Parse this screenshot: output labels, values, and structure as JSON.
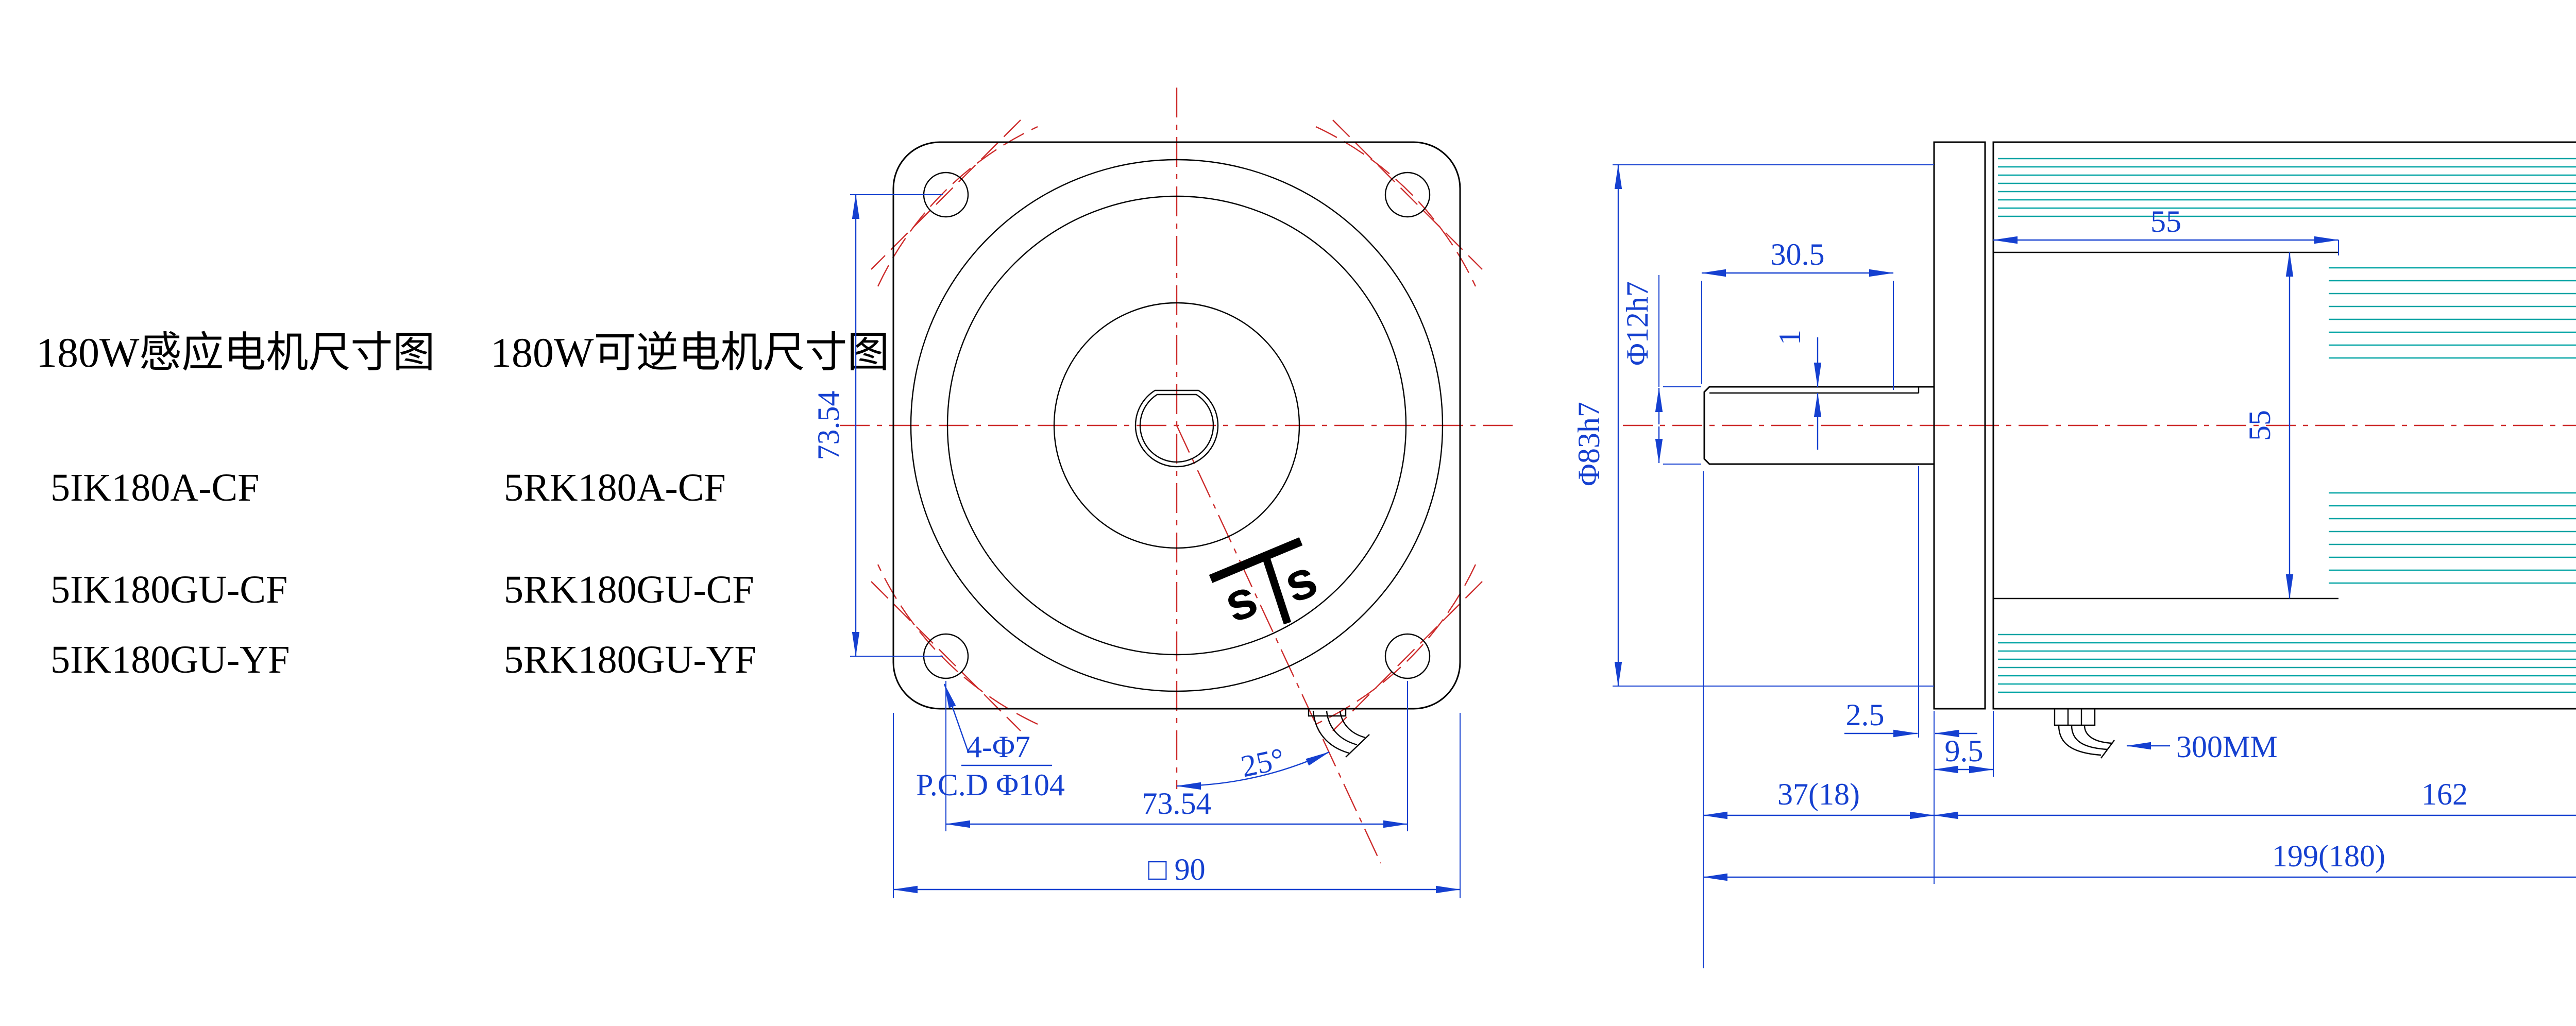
{
  "colors": {
    "background": "#ffffff",
    "outline_black": "#000000",
    "dimension_blue": "#1540d0",
    "centerline_red": "#cc2a2a",
    "fin_teal": "#00a3a3"
  },
  "left_panel": {
    "title_induction": "180W感应电机尺寸图",
    "title_reversible": "180W可逆电机尺寸图",
    "induction_models": [
      "5IK180A-CF",
      "5IK180GU-CF",
      "5IK180GU-YF"
    ],
    "reversible_models": [
      "5RK180A-CF",
      "5RK180GU-CF",
      "5RK180GU-YF"
    ]
  },
  "front_view": {
    "dim_bolt_spacing_vertical": "73.54",
    "dim_bolt_spacing_horizontal": "73.54",
    "dim_flange_square": "□ 90",
    "label_mounting_holes": "4-Φ7",
    "label_pitch_circle_dia": "P.C.D Φ104",
    "dim_cable_angle": "25°",
    "logo_letter_left": "s",
    "logo_letter_right": "s"
  },
  "side_view": {
    "dim_key_length": "30.5",
    "dim_key_depth": "1",
    "dim_shaft_dia": "Φ12h7",
    "dim_spigot_dia": "Φ83h7",
    "dim_front_section_length": "55",
    "dim_body_dia": "55",
    "dim_key_end_to_flange": "2.5",
    "dim_flange_thickness": "9.5",
    "dim_shaft_extension": "37(18)",
    "dim_body_length": "162",
    "dim_overall_length": "199(180)",
    "label_lead_wire_length": "300MM"
  }
}
